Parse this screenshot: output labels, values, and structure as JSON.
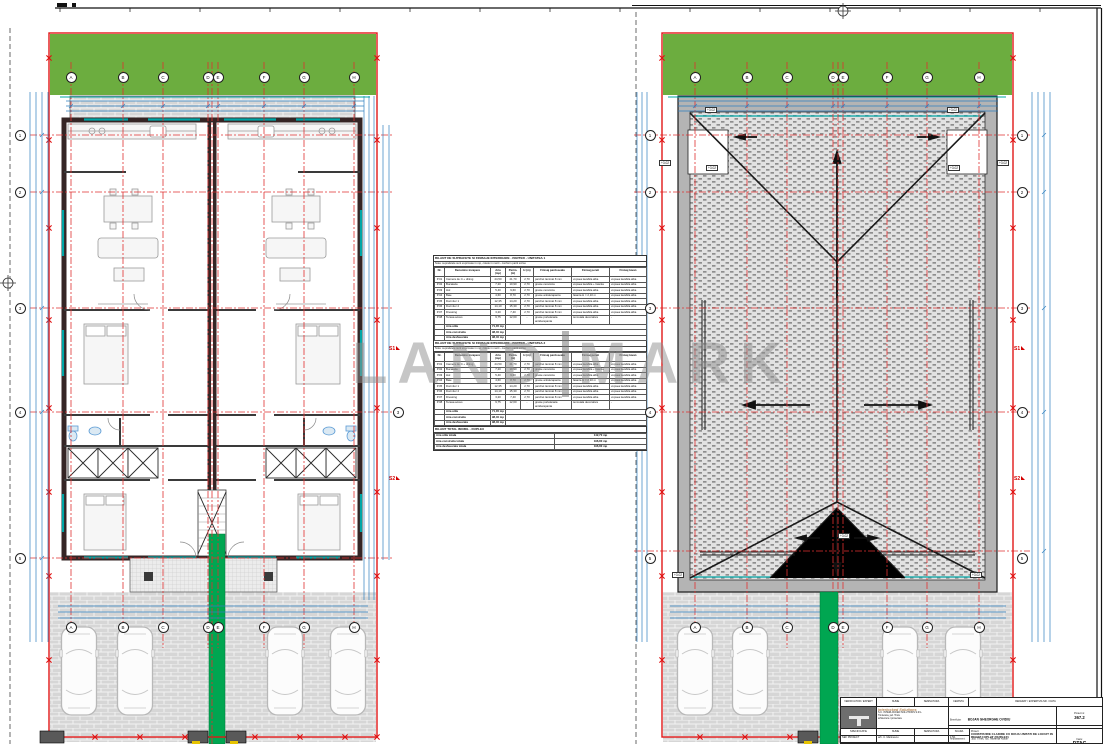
{
  "watermark": {
    "left": "LAND",
    "right": "MARK"
  },
  "grid": {
    "letters": [
      "A",
      "B",
      "C",
      "D",
      "E",
      "F",
      "G",
      "H"
    ],
    "numbers": [
      "1",
      "2",
      "3",
      "4",
      "5"
    ],
    "axis3": "3"
  },
  "sections": {
    "s1": "S1",
    "s2": "S2"
  },
  "roof": {
    "elevation": "+3.02"
  },
  "schedule": {
    "unit1_title": "BILANT DE SUPRAFETE SI FINISAJE INTERIOARE - PARTER - UNITATEA 1",
    "unit2_title": "BILANT DE SUPRAFETE SI FINISAJE INTERIOARE - PARTER - UNITATEA 2",
    "note": "Nota: suprafetele sunt exprimate in mp, cotele in metri - conform partii scrise",
    "headers": [
      "Nr.",
      "Denumire incapere",
      "Aria (mp)",
      "Perim. (m)",
      "H (m)",
      "Finisaj pardoseala",
      "Finisaj pereti",
      "Finisaj tavan"
    ],
    "rows": [
      [
        "P.01",
        "Camera de zi + dining",
        "24,50",
        "21,70",
        "2,70",
        "parchet laminat 8 mm",
        "vopsea lavabila alba",
        "vopsea lavabila alba"
      ],
      [
        "P.02",
        "Bucatarie",
        "7,20",
        "10,90",
        "2,70",
        "gresie ceramica",
        "vopsea lavabila + faianta",
        "vopsea lavabila alba"
      ],
      [
        "P.03",
        "Hol",
        "5,40",
        "9,60",
        "2,70",
        "gresie ceramica",
        "vopsea lavabila alba",
        "vopsea lavabila alba"
      ],
      [
        "P.04",
        "Baie",
        "4,60",
        "8,70",
        "2,70",
        "gresie antiderapanta",
        "faianta H = 2,10 m",
        "vopsea lavabila alba"
      ],
      [
        "P.05",
        "Dormitor 1",
        "12,35",
        "14,20",
        "2,70",
        "parchet laminat 8 mm",
        "vopsea lavabila alba",
        "vopsea lavabila alba"
      ],
      [
        "P.06",
        "Dormitor 2",
        "14,10",
        "15,30",
        "2,70",
        "parchet laminat 8 mm",
        "vopsea lavabila alba",
        "vopsea lavabila alba"
      ],
      [
        "P.07",
        "Dressing",
        "3,20",
        "7,40",
        "2,70",
        "parchet laminat 8 mm",
        "vopsea lavabila alba",
        "vopsea lavabila alba"
      ],
      [
        "P.08",
        "Terasa acces",
        "9,75",
        "12,60",
        "-",
        "gresie portelanata antiderapanta",
        "tencuiala decorativa",
        "-"
      ]
    ],
    "totals": [
      [
        "Aria utila",
        "71,35 mp"
      ],
      [
        "Aria construita",
        "98,40 mp"
      ],
      [
        "Aria desfasurata",
        "98,40 mp"
      ]
    ],
    "summary_title": "BILANT TOTAL IMOBIL - DUPLEX",
    "summary_rows": [
      [
        "Aria utila totala",
        "142,70 mp"
      ],
      [
        "Aria construita totala",
        "196,80 mp"
      ],
      [
        "Aria desfasurata totala",
        "196,80 mp"
      ]
    ]
  },
  "titleblock": {
    "verificator": "VERIFICATOR / EXPERT",
    "nume": "NUME",
    "semnatura": "SEMNATURA",
    "cerinta": "CERINTA",
    "referat": "REFERAT / EXPERTIZA NR. / DATA",
    "company_name": "Interlocked Solutions",
    "company_line1": "S.C. INTERLOCKED SOLUTIONS S.R.L.",
    "company_line2": "Timisoara, jud. Timis",
    "company_line3": "arhitectura / proiectare",
    "beneficiar_label": "Beneficiar:",
    "beneficiar": "BOJAN GHEORGHE OVIDIU",
    "proiect_nr_label": "Proiect nr.",
    "proiect_nr": "367.2",
    "amplasament_label": "Amplasament:",
    "amplasament": "jud. Timis, loc. Mosnita Noua",
    "specificatie": "SPECIFICATIE",
    "scara_label": "SCARA",
    "spec_rows": [
      [
        "SEF PROIECT",
        "arh. C. Marinescu",
        "",
        "1:50"
      ],
      [
        "PROIECTAT",
        "arh. C. Marinescu",
        "",
        "DATA"
      ],
      [
        "DESENAT",
        "arh. C. Marinescu",
        "",
        ""
      ]
    ],
    "proiect_label": "Proiect:",
    "proiect_titlu": "CONSTRUIRE CLADIRE CU DOUA UNITATI DE LOCUIT IN REGIM CUPLAT (DUPLEX)",
    "faza_label": "Faza:",
    "faza": "DTAC"
  }
}
